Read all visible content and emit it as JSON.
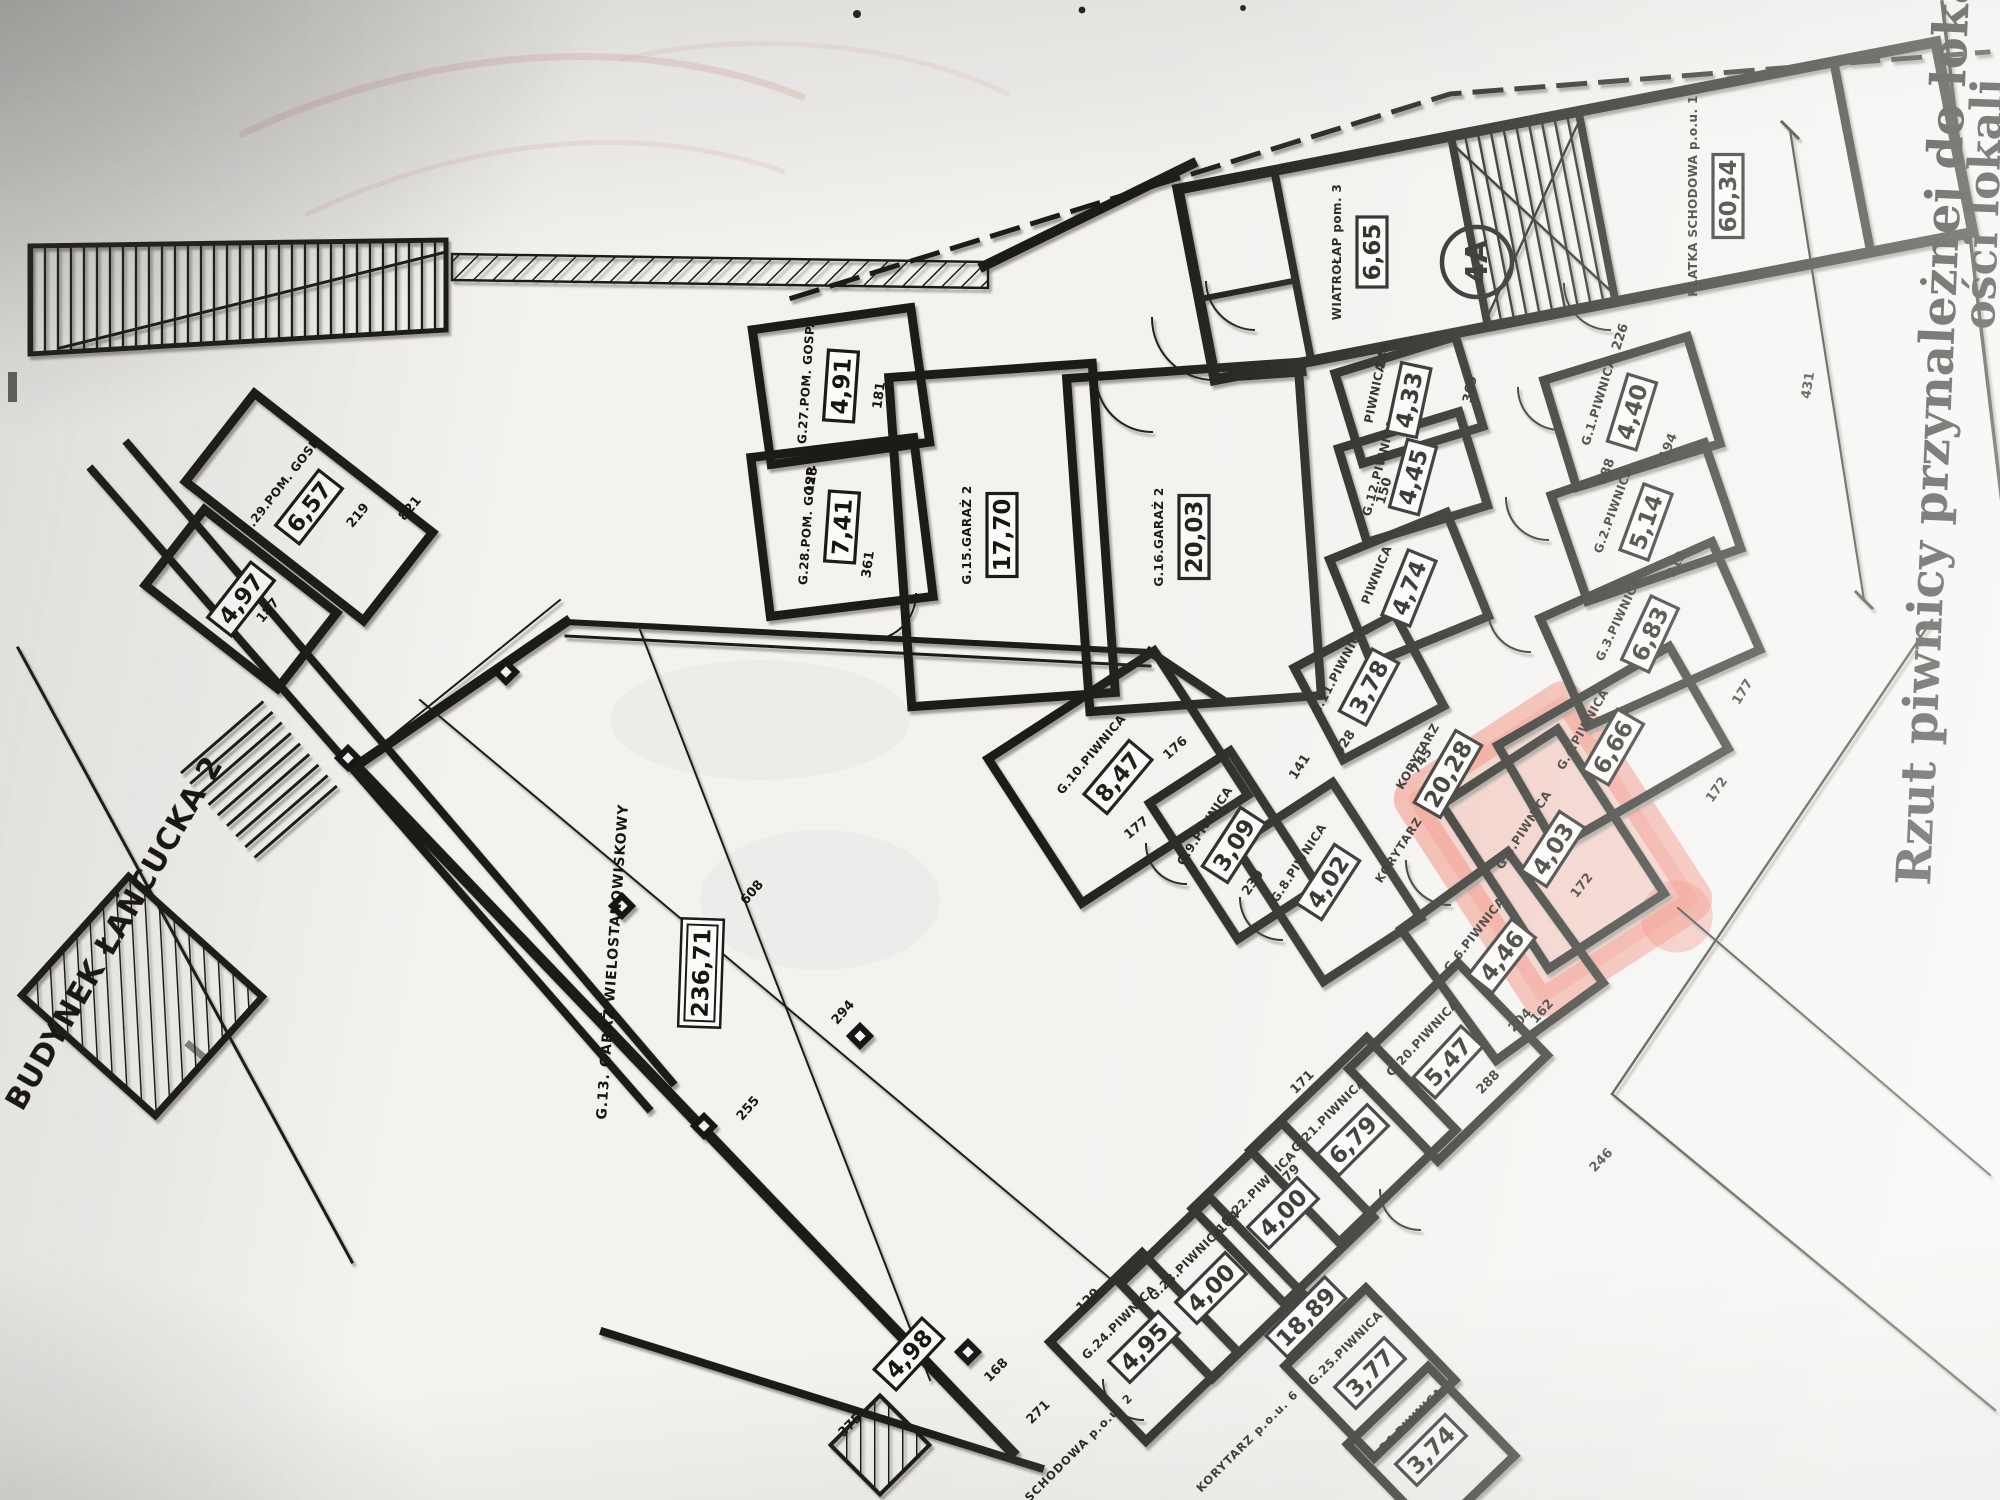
{
  "document": {
    "title": "Rzut piwnicy przynależnej do lokal",
    "title_cut": "ości lokali",
    "building_label": "BUDYNEK ŁAŃCUCKA 2",
    "unit_label": "4A",
    "highlight_color": "#ef6d5a"
  },
  "rooms": [
    {
      "id": "wiatrolap",
      "code": "WIATROŁAP pom. 3",
      "area": "6,65",
      "x": 1372,
      "y": 252,
      "textRot": -90,
      "wallRot": -11,
      "w": 0,
      "h": 0
    },
    {
      "id": "klatka-1",
      "code": "KLATKA SCHODOWA p.o.u. 1",
      "area": "60,34",
      "x": 1728,
      "y": 196,
      "textRot": -90,
      "wallRot": -11,
      "w": 0,
      "h": 0
    },
    {
      "id": "g1-piwnica",
      "code": "G.1.PIWNICA",
      "area": "4,40",
      "x": 1632,
      "y": 412,
      "textRot": -73,
      "wallRot": -17,
      "w": 150,
      "h": 112
    },
    {
      "id": "g2-piwnica",
      "code": "G.2.PIWNICA",
      "area": "5,14",
      "x": 1646,
      "y": 522,
      "textRot": -70,
      "wallRot": -19,
      "w": 162,
      "h": 112
    },
    {
      "id": "g3-piwnica",
      "code": "G.3.PIWNICA",
      "area": "6,83",
      "x": 1650,
      "y": 634,
      "textRot": -65,
      "wallRot": -24,
      "w": 188,
      "h": 118
    },
    {
      "id": "g4-piwnica",
      "code": "G.4.PIWNICA",
      "area": "6,66",
      "x": 1613,
      "y": 747,
      "textRot": -60,
      "wallRot": -30,
      "w": 198,
      "h": 118
    },
    {
      "id": "g5-piwnica",
      "code": "G.5.PIWNICA",
      "area": "4,03",
      "x": 1553,
      "y": 849,
      "textRot": -57,
      "wallRot": -33,
      "w": 138,
      "h": 196,
      "red": true
    },
    {
      "id": "g6-piwnica",
      "code": "G.6.PIWNICA",
      "area": "4,46",
      "x": 1502,
      "y": 956,
      "textRot": -52,
      "wallRot": -36,
      "w": 132,
      "h": 162
    },
    {
      "id": "g8-piwnica",
      "code": "G.8.PIWNICA",
      "area": "4,02",
      "x": 1328,
      "y": 882,
      "textRot": -57,
      "wallRot": -33,
      "w": 116,
      "h": 162
    },
    {
      "id": "g9-piwnica",
      "code": "G.9.PIWNICA",
      "area": "3,09",
      "x": 1234,
      "y": 845,
      "textRot": -57,
      "wallRot": -33,
      "w": 96,
      "h": 162
    },
    {
      "id": "g10-piwnica",
      "code": "G.10.PIWNICA",
      "area": "8,47",
      "x": 1118,
      "y": 777,
      "textRot": -50,
      "wallRot": -33,
      "w": 198,
      "h": 172
    },
    {
      "id": "g11-piwnica",
      "code": "G.11.PIWNICA",
      "area": "3,78",
      "x": 1369,
      "y": 687,
      "textRot": -62,
      "wallRot": -28,
      "w": 114,
      "h": 104
    },
    {
      "id": "g12-piwnica",
      "code": "G.12.PIWNICA",
      "area": "4,45",
      "x": 1413,
      "y": 477,
      "textRot": -75,
      "wallRot": -17,
      "w": 126,
      "h": 98
    },
    {
      "id": "piwnica-433",
      "code": "PIWNICA",
      "area": "4,33",
      "x": 1409,
      "y": 400,
      "textRot": -78,
      "wallRot": -17,
      "w": 126,
      "h": 94
    },
    {
      "id": "piwnica-474",
      "code": "PIWNICA",
      "area": "4,74",
      "x": 1409,
      "y": 588,
      "textRot": -68,
      "wallRot": -22,
      "w": 126,
      "h": 112
    },
    {
      "id": "korytarz-2028",
      "code": "KORYTARZ",
      "area": "20,28",
      "x": 1448,
      "y": 774,
      "textRot": -60,
      "wallRot": -30,
      "w": 0,
      "h": 0
    },
    {
      "id": "g20-piwnica",
      "code": "G.20.PIWNICA",
      "area": "5,47",
      "x": 1448,
      "y": 1062,
      "textRot": -47,
      "wallRot": -44,
      "w": 152,
      "h": 128
    },
    {
      "id": "g21-piwnica",
      "code": "G.21.PIWNICA",
      "area": "6,79",
      "x": 1353,
      "y": 1140,
      "textRot": -45,
      "wallRot": -44,
      "w": 162,
      "h": 128
    },
    {
      "id": "g22-piwnica",
      "code": "G.22.PIWNICA",
      "area": "4,00",
      "x": 1283,
      "y": 1213,
      "textRot": -45,
      "wallRot": -44,
      "w": 124,
      "h": 132
    },
    {
      "id": "g23-piwnica",
      "code": "G.23.PIWNICA",
      "area": "4,00",
      "x": 1211,
      "y": 1288,
      "textRot": -45,
      "wallRot": -44,
      "w": 124,
      "h": 132
    },
    {
      "id": "g24-piwnica",
      "code": "G.24.PIWNICA",
      "area": "4,95",
      "x": 1144,
      "y": 1347,
      "textRot": -45,
      "wallRot": -44,
      "w": 128,
      "h": 138
    },
    {
      "id": "korytarz-pou6",
      "code": "",
      "area": "18,89",
      "x": 1306,
      "y": 1317,
      "textRot": -45,
      "wallRot": -44,
      "w": 0,
      "h": 0
    },
    {
      "id": "g25-piwnica",
      "code": "G.25.PIWNICA",
      "area": "3,77",
      "x": 1370,
      "y": 1373,
      "textRot": -45,
      "wallRot": -44,
      "w": 112,
      "h": 128
    },
    {
      "id": "g26-piwnica",
      "code": "G.26.PIWNICA",
      "area": "3,74",
      "x": 1431,
      "y": 1450,
      "textRot": -45,
      "wallRot": -44,
      "w": 112,
      "h": 124
    },
    {
      "id": "pom-498",
      "code": "",
      "area": "4,98",
      "x": 909,
      "y": 1354,
      "textRot": -47,
      "wallRot": -46,
      "w": 0,
      "h": 0
    },
    {
      "id": "g15-garaz",
      "code": "G.15.GARAŻ 2",
      "area": "17,70",
      "x": 1002,
      "y": 535,
      "textRot": -90,
      "wallRot": -4,
      "w": 204,
      "h": 330
    },
    {
      "id": "g16-garaz",
      "code": "G.16.GARAŻ 2",
      "area": "20,03",
      "x": 1194,
      "y": 537,
      "textRot": -90,
      "wallRot": -4,
      "w": 232,
      "h": 334
    },
    {
      "id": "g28-pom-gosp",
      "code": "G.28.POM. GOSP.",
      "area": "7,41",
      "x": 842,
      "y": 527,
      "textRot": -86,
      "wallRot": -7,
      "w": 164,
      "h": 160
    },
    {
      "id": "g27-pom-gosp",
      "code": "G.27.POM. GOSP.",
      "area": "4,91",
      "x": 841,
      "y": 386,
      "textRot": -86,
      "wallRot": -8,
      "w": 160,
      "h": 136
    },
    {
      "id": "g29-pom-gosp",
      "code": "G.29.POM. GOSP.",
      "area": "6,57",
      "x": 309,
      "y": 507,
      "textRot": -52,
      "wallRot": -52,
      "w": 112,
      "h": 226
    },
    {
      "id": "pom-497",
      "code": "",
      "area": "4,97",
      "x": 241,
      "y": 599,
      "textRot": -52,
      "wallRot": -52,
      "w": 96,
      "h": 168
    },
    {
      "id": "g13-garaz-hala",
      "code": "",
      "area": "236,71",
      "x": 701,
      "y": 973,
      "textRot": -88,
      "wallRot": 0,
      "w": 0,
      "h": 0,
      "dbl": true
    }
  ],
  "labels": [
    {
      "text": "G.13. GARAŻ WIELOSTANOWISKOWY",
      "x": 617,
      "y": 962,
      "rot": -86,
      "size": 14
    },
    {
      "text": "BUDYNEK ŁAŃCUCKA 2",
      "x": 123,
      "y": 938,
      "rot": -60,
      "size": 30
    },
    {
      "text": "KLATKA SCHODOWA p.o.u. 2",
      "x": 1060,
      "y": 1472,
      "rot": -45,
      "size": 11.5
    },
    {
      "text": "KORYTARZ",
      "x": 1402,
      "y": 852,
      "rot": -57,
      "size": 11.5
    },
    {
      "text": "KORYTARZ p.o.u. 6",
      "x": 1250,
      "y": 1444,
      "rot": -45,
      "size": 11.5
    }
  ],
  "dims": [
    [
      "431",
      1812,
      386,
      -81
    ],
    [
      "226",
      1624,
      338,
      -72
    ],
    [
      "194",
      1672,
      448,
      -68
    ],
    [
      "688",
      1610,
      473,
      -70
    ],
    [
      "213",
      1680,
      566,
      -63
    ],
    [
      "177",
      1746,
      694,
      -58
    ],
    [
      "172",
      1720,
      792,
      -55
    ],
    [
      "172",
      1585,
      888,
      -52
    ],
    [
      "162",
      1545,
      1014,
      -48
    ],
    [
      "150",
      1388,
      492,
      -74
    ],
    [
      "148",
      1387,
      357,
      -76
    ],
    [
      "369",
      1474,
      390,
      -78
    ],
    [
      "361",
      872,
      565,
      -82
    ],
    [
      "181",
      883,
      396,
      -82
    ],
    [
      "128",
      815,
      481,
      -80
    ],
    [
      "230",
      1256,
      885,
      -55
    ],
    [
      "141",
      1303,
      769,
      -57
    ],
    [
      "628",
      1348,
      745,
      -56
    ],
    [
      "745",
      1425,
      763,
      -56
    ],
    [
      "176",
      1178,
      751,
      -42
    ],
    [
      "177",
      1139,
      831,
      -40
    ],
    [
      "219",
      361,
      518,
      -50
    ],
    [
      "821",
      413,
      511,
      -50
    ],
    [
      "187",
      271,
      613,
      -50
    ],
    [
      "608",
      755,
      895,
      -49
    ],
    [
      "255",
      751,
      1111,
      -49
    ],
    [
      "294",
      846,
      1015,
      -49
    ],
    [
      "288",
      1491,
      1085,
      -46
    ],
    [
      "246",
      1604,
      1163,
      -46
    ],
    [
      "171",
      1305,
      1085,
      -45
    ],
    [
      "179",
      1291,
      1179,
      -45
    ],
    [
      "164",
      1231,
      1225,
      -45
    ],
    [
      "129",
      1091,
      1303,
      -45
    ],
    [
      "271",
      1041,
      1415,
      -45
    ],
    [
      "375",
      853,
      1428,
      -45
    ],
    [
      "168",
      999,
      1373,
      -45
    ],
    [
      "204",
      1523,
      1023,
      -46
    ]
  ]
}
